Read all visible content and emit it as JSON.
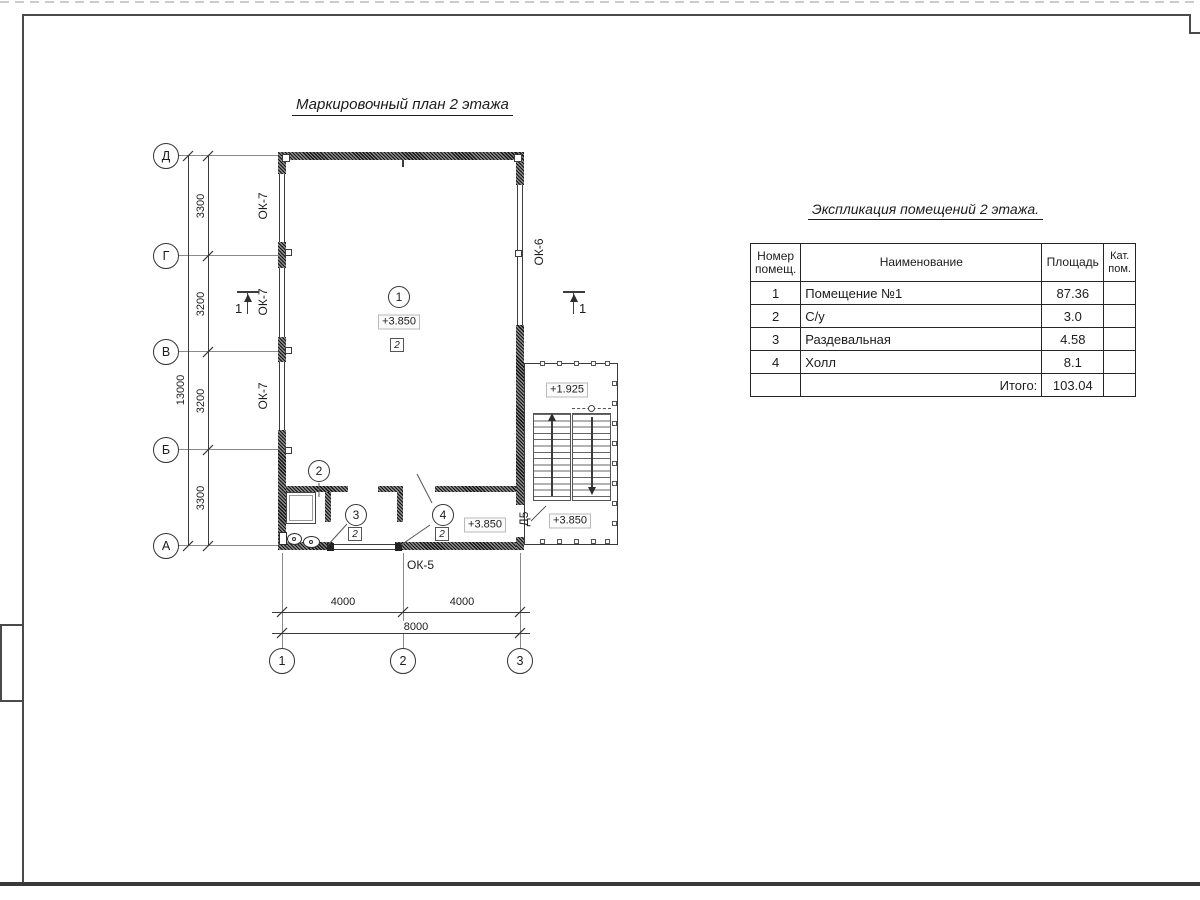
{
  "drawing": {
    "title": "Маркировочный план 2 этажа",
    "axes": {
      "h": [
        "Д",
        "Г",
        "В",
        "Б",
        "А"
      ],
      "v": [
        "1",
        "2",
        "3"
      ]
    },
    "dims": {
      "left": [
        "3300",
        "3200",
        "3200",
        "3300"
      ],
      "left_total": "13000",
      "bottom": [
        "4000",
        "4000"
      ],
      "bottom_total": "8000"
    },
    "labels": {
      "ok7": "ОК-7",
      "ok6": "ОК-6",
      "ok5": "ОК-5",
      "d5": "Д5"
    },
    "rooms": [
      "1",
      "2",
      "3",
      "4"
    ],
    "floor_type": "2",
    "elev": {
      "room1": "+3.850",
      "landing": "+1.925",
      "hall": "+3.850",
      "annex": "+3.850"
    },
    "section": "1"
  },
  "table": {
    "title": "Экспликация помещений 2 этажа.",
    "headers": {
      "num": "Номер помещ.",
      "name": "Наименование",
      "area": "Площадь",
      "cat": "Кат. пом."
    },
    "rows": [
      {
        "num": "1",
        "name": "Помещение №1",
        "area": "87.36",
        "cat": ""
      },
      {
        "num": "2",
        "name": "С/у",
        "area": "3.0",
        "cat": ""
      },
      {
        "num": "3",
        "name": "Раздевальная",
        "area": "4.58",
        "cat": ""
      },
      {
        "num": "4",
        "name": "Холл",
        "area": "8.1",
        "cat": ""
      }
    ],
    "total_label": "Итого:",
    "total_value": "103.04"
  }
}
